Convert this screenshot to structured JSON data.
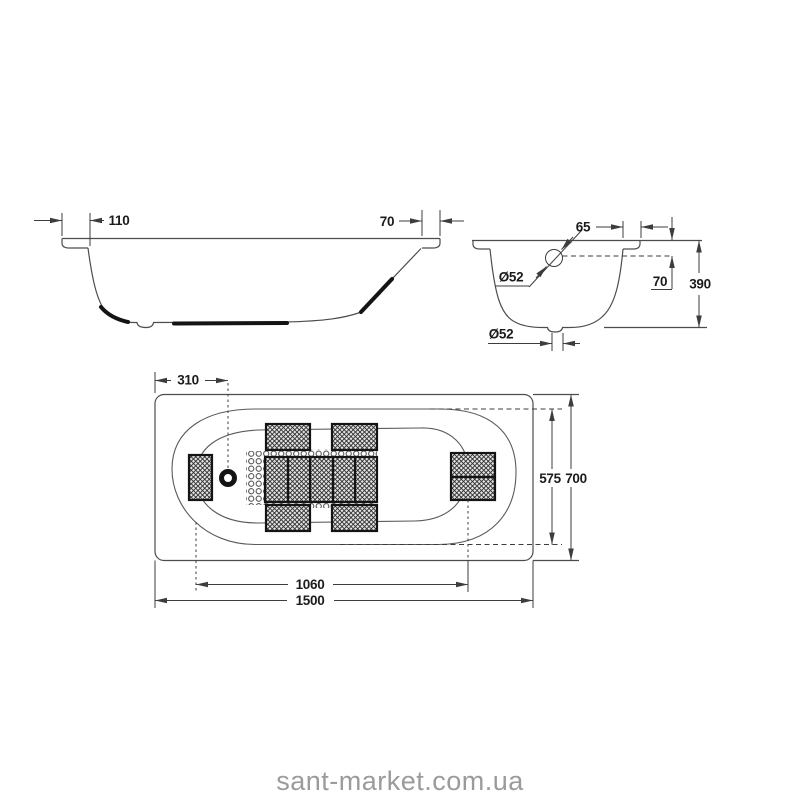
{
  "watermark": "sant-market.com.ua",
  "views": {
    "side": {
      "dims": {
        "rim_left_width": "110",
        "rim_right_width": "70"
      }
    },
    "section": {
      "dims": {
        "rim_width": "65",
        "overflow_depth": "70",
        "height": "390",
        "overflow_diameter": "Ø52",
        "drain_diameter": "Ø52"
      }
    },
    "top": {
      "dims": {
        "drain_offset": "310",
        "inner_width": "575",
        "outer_width": "700",
        "floor_length": "1060",
        "outer_length": "1500"
      }
    }
  },
  "colors": {
    "line": "#4d4d4d",
    "dark": "#141414",
    "text": "#1c1c1c",
    "watermark": "#9b9b9b"
  }
}
